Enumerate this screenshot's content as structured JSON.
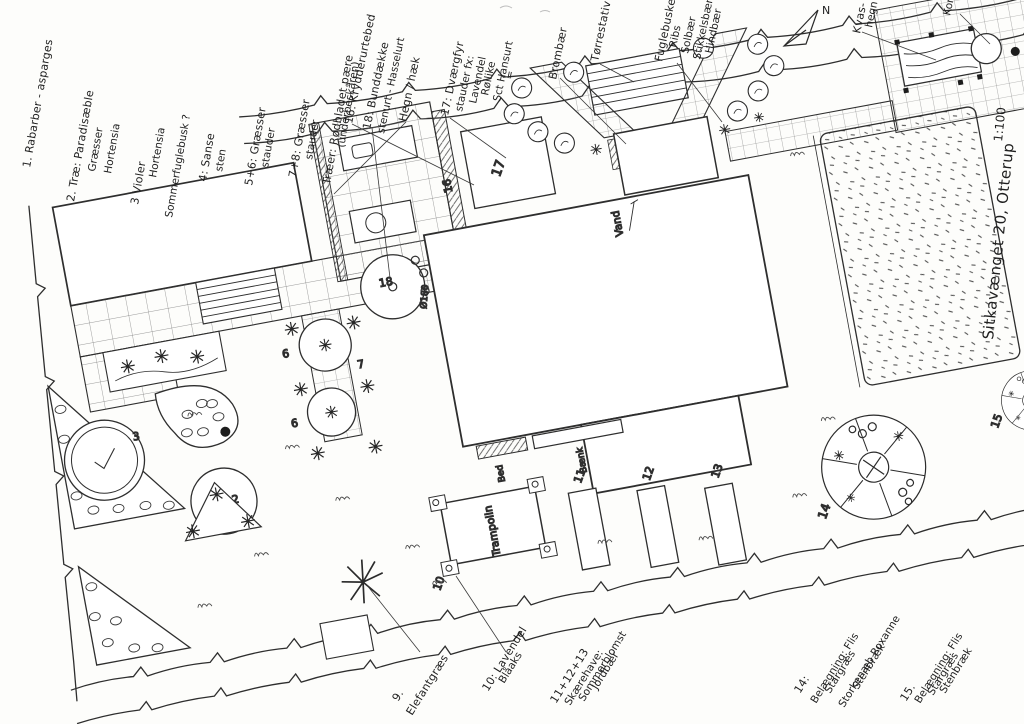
{
  "plan": {
    "address": "Sitkavænget 20, Otterup",
    "scale": "1:100",
    "compass": "N",
    "vand": "Vand",
    "baenk": "Bænk",
    "bed": "Bed",
    "trampolin": "Trampolin",
    "dia180": "Ø180",
    "n2": "2",
    "n3": "3",
    "n5": "5",
    "n6": "6",
    "n7": "7",
    "n10": "10",
    "n11": "11",
    "n12": "12",
    "n13": "13",
    "n14": "14",
    "n15": "15",
    "n16": "16",
    "n17": "17",
    "n18": "18"
  },
  "legend_top": [
    {
      "lines": [
        "1. Rabarber - asparges"
      ]
    },
    {
      "lines": [
        "2. Træ: Paradisæble",
        "Græsser",
        "Hortensia"
      ]
    },
    {
      "lines": [
        "3 Violer",
        "Hortensia",
        "Sommerfuglebusk ?"
      ]
    },
    {
      "lines": [
        "4: Sanse",
        "sten"
      ]
    },
    {
      "lines": [
        "5+6: Græsser",
        "stauder"
      ]
    },
    {
      "lines": [
        "7+8: Græsser",
        "stauder",
        "Træer: Rødbladet pære",
        "(underbeskåren)"
      ]
    },
    {
      "lines": [
        "16: Krydderurtebed"
      ]
    },
    {
      "lines": [
        "18: Bunddække",
        "stenurt - Hasselurt"
      ]
    },
    {
      "lines": [
        "Hegn / hæk"
      ]
    },
    {
      "lines": [
        "17: Dværgfyr",
        "stauder fx:",
        "Lavendel",
        "Røllike",
        "Sct Hansurt",
        "="
      ]
    },
    {
      "lines": [
        "Brombær"
      ]
    },
    {
      "lines": [
        "Tørrestativ"
      ]
    },
    {
      "lines": [
        "Fuglebuske:",
        "Ribs",
        "Solbær",
        "Stikkelsbær",
        "Hindbær"
      ]
    },
    {
      "lines": [
        "Kvas-",
        "hegn"
      ]
    },
    {
      "lines": [
        "Kompost"
      ]
    }
  ],
  "legend_bottom": [
    {
      "lines": [
        "9.",
        "Elefantgræs"
      ]
    },
    {
      "lines": [
        "10: Lavendel",
        "Blåaks"
      ]
    },
    {
      "lines": [
        "11+12+13",
        "Skærehave:",
        "Sommerblomst",
        "Jordbær"
      ]
    },
    {
      "lines": [
        "14:",
        "Belægning: Flis",
        "Stargræs",
        "Storkenæb Roxanne",
        "Stenbræk"
      ]
    },
    {
      "lines": [
        "15.",
        "Belægning: Flis",
        "Stargræs",
        "Stenbræk"
      ]
    }
  ]
}
